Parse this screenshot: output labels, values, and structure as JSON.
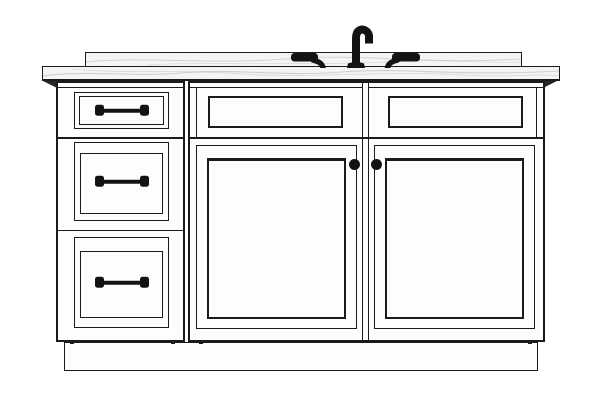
{
  "illustration": {
    "title": "Bathroom vanity cabinet — front elevation line drawing",
    "style": "black outline shaker cabinetry on white background",
    "colors": {
      "background": "#ffffff",
      "outline": "#1b1b1b",
      "surface": "#fdfdfc",
      "hardware": "#131313",
      "marble": "#f4f4f2",
      "marble_vein": "#b7bbc1",
      "shadow": "#23262b"
    },
    "parts": {
      "faucet": {
        "label": "Matte black gooseneck faucet with two lever handles",
        "finish": "matte black"
      },
      "backsplash": {
        "label": "Marble backsplash"
      },
      "countertop": {
        "label": "Marble countertop slab with overhang"
      },
      "drawer_cabinet": {
        "label": "Left bank of three shaker drawers",
        "drawers": [
          {
            "label": "Top drawer",
            "hardware": "black bar pull"
          },
          {
            "label": "Middle drawer",
            "hardware": "black bar pull"
          },
          {
            "label": "Bottom drawer",
            "hardware": "black bar pull"
          }
        ]
      },
      "door_cabinet": {
        "label": "Right sink cabinet with two shaker doors and two false drawer fronts",
        "false_fronts": 2,
        "doors": [
          {
            "label": "Left door",
            "hardware": "round black knob"
          },
          {
            "label": "Right door",
            "hardware": "round black knob"
          }
        ]
      },
      "toe_kick": {
        "label": "Recessed toe-kick base"
      }
    }
  }
}
